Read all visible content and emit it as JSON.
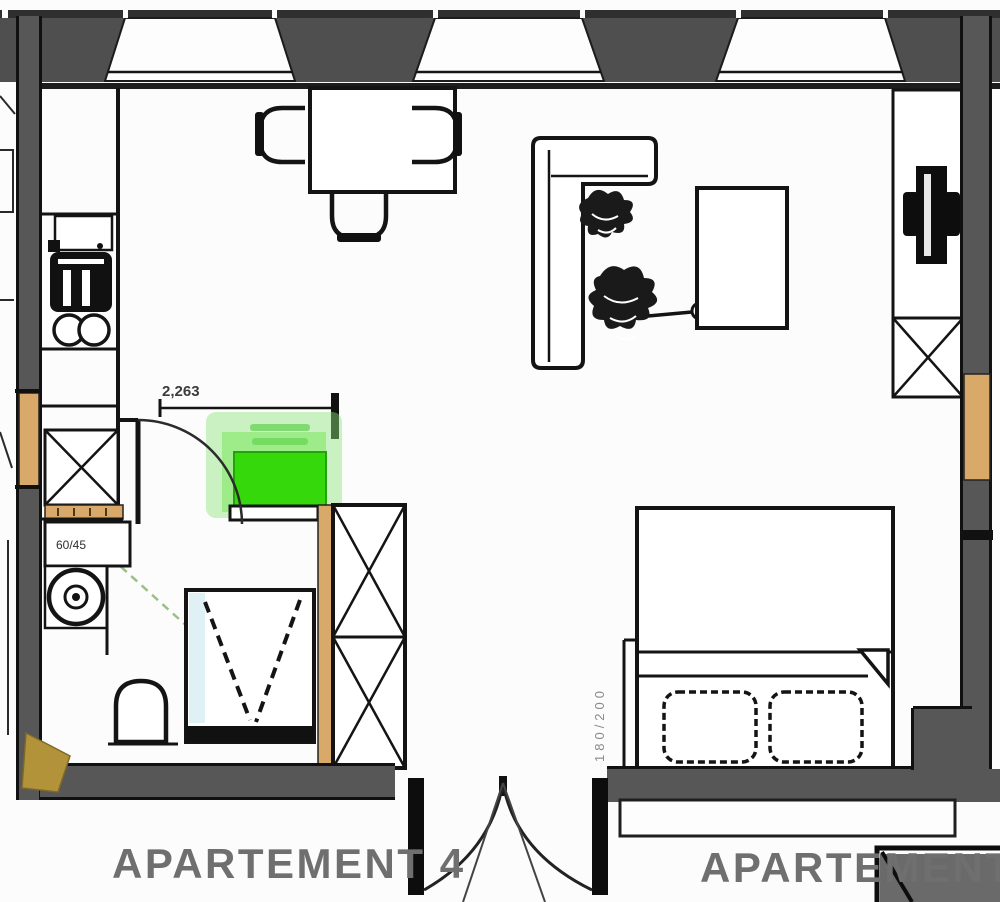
{
  "plan": {
    "type": "apartment-floor-plan",
    "labels": {
      "apartment_left": "APARTEMENT 4",
      "apartment_right": "APARTEMENT",
      "dimension": "2,263",
      "washbasin_size": "60/45",
      "bed_size": "180/200"
    },
    "colors": {
      "wall_gray": "#575757",
      "wall_dark": "#1d1d1d",
      "wood_orange": "#d9a96a",
      "wood_tan": "#b39339",
      "highlight_green": "#35d90b",
      "highlight_glow": "#8fe57d",
      "plumbing_green": "#9cbf86",
      "shower_blue": "#bfe3ea",
      "label_gray": "#6f6f6f"
    },
    "rooms": [
      "kitchen",
      "living-dining",
      "bathroom",
      "sleeping-area"
    ],
    "furniture": [
      "kitchen-counter",
      "stove",
      "hob-rings",
      "tall-cabinet",
      "dining-table",
      "chairs",
      "sofa",
      "plants",
      "coffee-table",
      "tv",
      "tv-bench",
      "lowboard-cabinet",
      "highlighted-unit",
      "wardrobe",
      "washbasin",
      "washing-machine",
      "toilet",
      "shower",
      "double-bed",
      "pillows"
    ]
  }
}
